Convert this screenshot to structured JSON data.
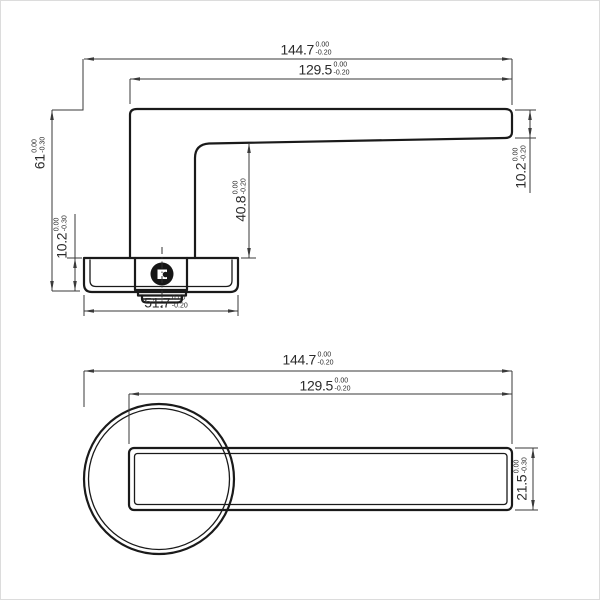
{
  "colors": {
    "background": "#ffffff",
    "part_line": "#1a1a1a",
    "dim_line": "#3a3a3a",
    "text": "#2b2b2b"
  },
  "side_view": {
    "dimensions": [
      {
        "id": "overall-length",
        "value": "144.7",
        "tol_upper": "0.00",
        "tol_lower": "-0.20"
      },
      {
        "id": "lever-length",
        "value": "129.5",
        "tol_upper": "0.00",
        "tol_lower": "-0.20"
      },
      {
        "id": "overall-height",
        "value": "61",
        "tol_upper": "0.00",
        "tol_lower": "-0.30"
      },
      {
        "id": "rose-height",
        "value": "10.2",
        "tol_upper": "0.00",
        "tol_lower": "-0.30"
      },
      {
        "id": "underside-to-rose",
        "value": "40.8",
        "tol_upper": "0.00",
        "tol_lower": "-0.20"
      },
      {
        "id": "lever-thickness",
        "value": "10.2",
        "tol_upper": "0.00",
        "tol_lower": "-0.20"
      },
      {
        "id": "rose-width",
        "value": "51.7",
        "tol_upper": "0.00",
        "tol_lower": "-0.20"
      }
    ]
  },
  "plan_view": {
    "dimensions": [
      {
        "id": "overall-length",
        "value": "144.7",
        "tol_upper": "0.00",
        "tol_lower": "-0.20"
      },
      {
        "id": "lever-length",
        "value": "129.5",
        "tol_upper": "0.00",
        "tol_lower": "-0.20"
      },
      {
        "id": "lever-width",
        "value": "21.5",
        "tol_upper": "0.00",
        "tol_lower": "-0.30"
      }
    ]
  }
}
